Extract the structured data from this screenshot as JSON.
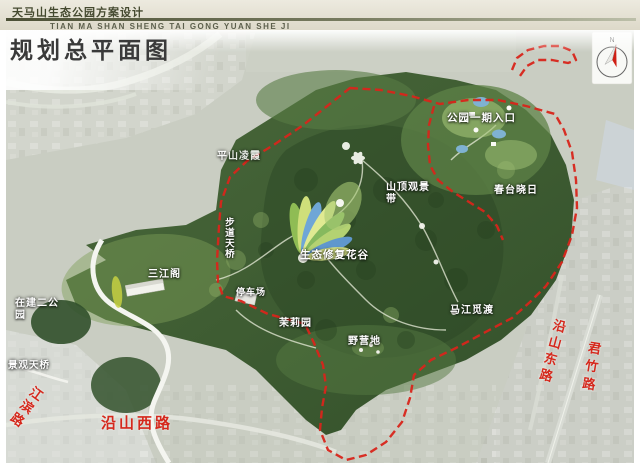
{
  "header": {
    "project_title": "天马山生态公园方案设计",
    "project_title_pinyin": "TIAN MA SHAN SHENG TAI GONG YUAN SHE JI",
    "drawing_title": "规划总平面图"
  },
  "compass": {
    "label": "N"
  },
  "map": {
    "site_labels": [
      {
        "id": "pingshan-lingxia",
        "text": "平山凌霞"
      },
      {
        "id": "park-phase1-entrance",
        "text": "公园一期入口"
      },
      {
        "id": "summit-viewing-belt",
        "text": "山顶观景带"
      },
      {
        "id": "chuntai-xiaori",
        "text": "春台晓日"
      },
      {
        "id": "eco-restoration-flower-valley",
        "text": "生态修复花谷"
      },
      {
        "id": "trail-footbridge",
        "text": "步道天桥"
      },
      {
        "id": "sanjiang-pavilion",
        "text": "三江阁"
      },
      {
        "id": "second-park-in-construction",
        "text": "在建二公园"
      },
      {
        "id": "parking-lot",
        "text": "停车场"
      },
      {
        "id": "jasmine-garden",
        "text": "茉莉园"
      },
      {
        "id": "campground",
        "text": "野营地"
      },
      {
        "id": "majiang-midu",
        "text": "马江觅渡"
      },
      {
        "id": "landscape-footbridge",
        "text": "景观天桥"
      }
    ],
    "road_labels": [
      {
        "id": "jiangbin-road",
        "text": "江滨路"
      },
      {
        "id": "yanshan-west-road",
        "text": "沿山西路"
      },
      {
        "id": "yanshan-east-road",
        "text": "沿山东路"
      },
      {
        "id": "junzhu-road",
        "text": "君竹路"
      }
    ],
    "colors": {
      "boundary_red": "#d5281c",
      "road_label_red": "#d5281c",
      "mountain_green": "#3d5a32",
      "urban_gray": "#c9cdc2",
      "header_olive": "#4c5036"
    }
  }
}
